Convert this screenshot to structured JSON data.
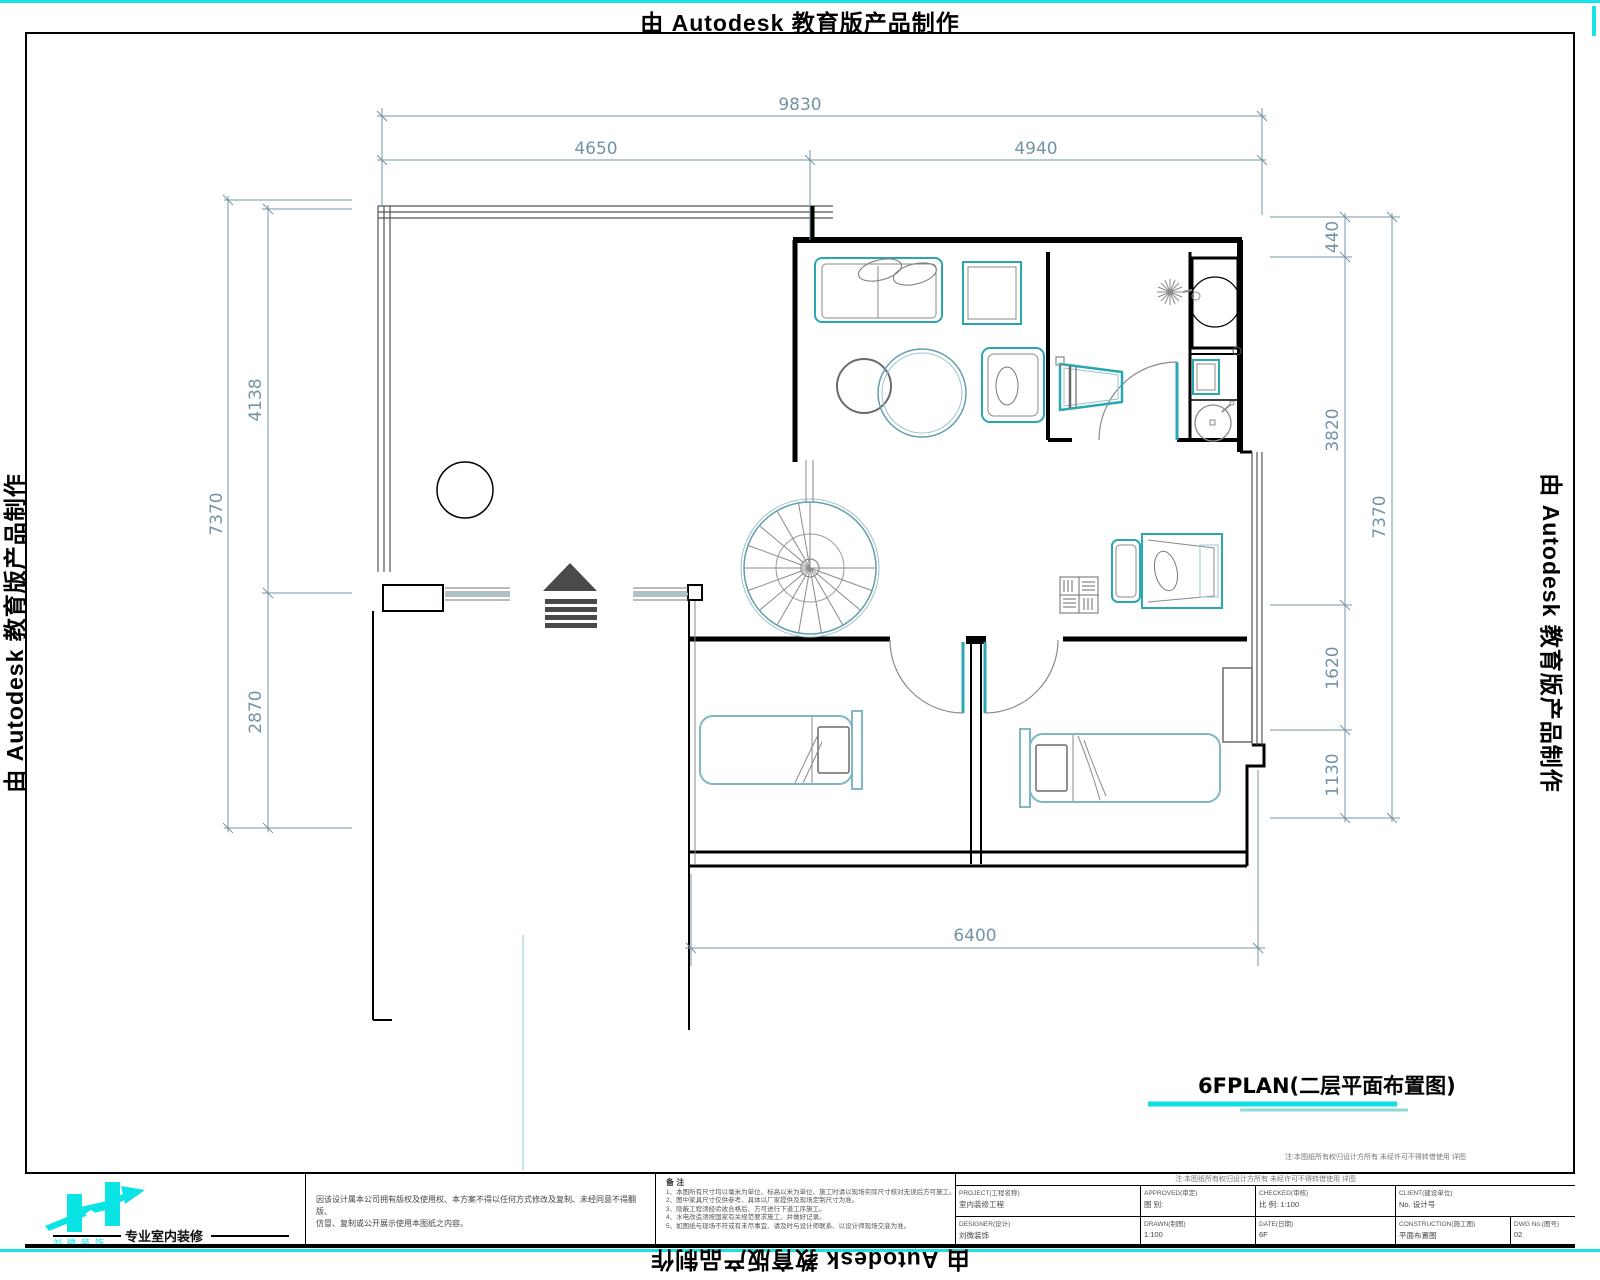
{
  "watermark": {
    "text": "由 Autodesk 教育版产品制作"
  },
  "dims": {
    "top_overall": "9830",
    "top_left": "4650",
    "top_right": "4940",
    "left_overall": "7370",
    "left_upper": "4138",
    "left_lower": "2870",
    "right_overall": "7370",
    "right_1": "440",
    "right_2": "3820",
    "right_3": "1620",
    "right_4": "1130",
    "bottom_overall": "6400"
  },
  "plan_title": {
    "text": "6FPLAN(二层平面布置图)"
  },
  "strip_note": "注:本图纸所有权归设计方所有 未经许可不得转借使用 详图",
  "title_block": {
    "logo": {
      "sub": "刘微装饰",
      "slogan": "专业室内装修"
    },
    "disclaimer": {
      "line1": "因该设计属本公司拥有版权及使用权、本方案不得以任何方式修改及复制、未经同意不得翻版、",
      "line2": "仿冒、复制或公开展示使用本图纸之内容。"
    },
    "notes": {
      "header": "备 注",
      "items": [
        "1、本图所有尺寸均以毫米为单位、标高以米为单位、施工时请以现场实际尺寸核对无误后方可施工。",
        "2、图中家具尺寸仅供参考、具体以厂家提供及现场定制尺寸为准。",
        "3、隐蔽工程须经验收合格后、方可进行下道工序施工。",
        "4、水电改造须按国家有关规范要求施工、并做好记录。",
        "5、如图纸与现场不符或有未尽事宜、请及时与设计师联系、以设计师现场交底为准。"
      ]
    },
    "fields": {
      "row1": [
        {
          "label": "PROJECT(工程名称)",
          "value": "室内装修工程"
        },
        {
          "label": "APPROVED(审定)",
          "value": "图 别:"
        },
        {
          "label": "CHECKED(审核)",
          "value": "比 例:  1:100"
        },
        {
          "label": "CLIENT(建设单位)",
          "value": "No. 设计号"
        }
      ],
      "row2": [
        {
          "label": "DESIGNER(设计)",
          "value": "刘微装饰"
        },
        {
          "label": "DRAWN(制图)",
          "value": "1:100"
        },
        {
          "label": "DATE(日期)",
          "value": "6F"
        },
        {
          "label": "CONSTRUCTION(施工图)",
          "value": "平面布置图"
        },
        {
          "label": "DWG No.(图号)",
          "value": "02"
        }
      ]
    }
  },
  "colors": {
    "accent_cyan": "#18e2e6",
    "furniture_teal": "#2aa7b2",
    "dimension_blue": "#7494a4",
    "wall_black": "#000000"
  }
}
